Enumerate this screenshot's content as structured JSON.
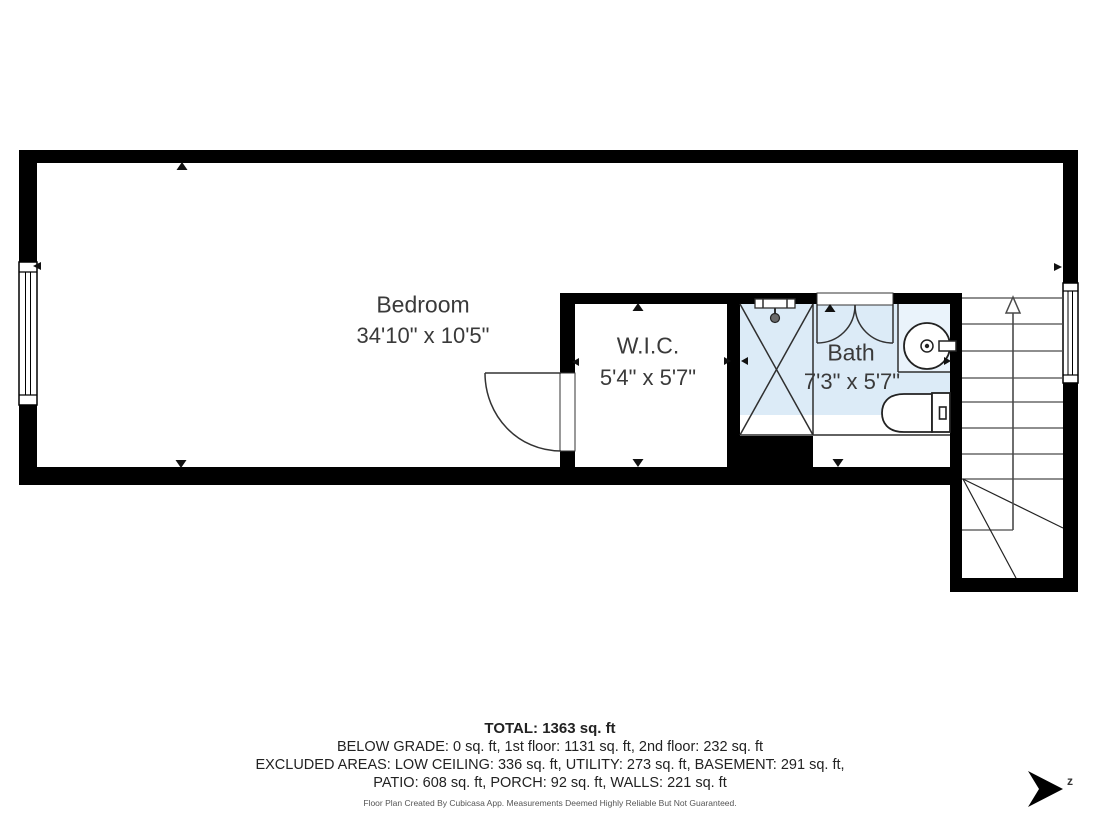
{
  "plan": {
    "rooms": [
      {
        "id": "bedroom",
        "label": "Bedroom",
        "dims": "34'10\" x 10'5\""
      },
      {
        "id": "wic",
        "label": "W.I.C.",
        "dims": "5'4\" x 5'7\""
      },
      {
        "id": "bath",
        "label": "Bath",
        "dims": "7'3\" x 5'7\""
      }
    ],
    "icons": [
      "shower-icon",
      "sink-icon",
      "toilet-icon",
      "stairs-up-arrow-icon",
      "window-icon",
      "door-swing-icon",
      "north-arrow-icon"
    ],
    "colors": {
      "wall": "#000000",
      "wet_room_floor": "#dcebf7",
      "counter_fill": "#eaf3fb",
      "thin_line": "#2f2f2f",
      "stair_line": "#4a4a4a"
    }
  },
  "summary": {
    "total": "TOTAL: 1363 sq. ft",
    "line1": "BELOW GRADE: 0 sq. ft, 1st floor: 1131 sq. ft, 2nd floor: 232 sq. ft",
    "line2": "EXCLUDED AREAS: LOW CEILING: 336 sq. ft, UTILITY: 273 sq. ft, BASEMENT: 291 sq. ft,",
    "line3": "PATIO: 608 sq. ft, PORCH: 92 sq. ft, WALLS: 221 sq. ft"
  },
  "footer": {
    "disclaimer": "Floor Plan Created By Cubicasa App. Measurements Deemed Highly Reliable But Not Guaranteed."
  },
  "compass": {
    "label": "z"
  }
}
